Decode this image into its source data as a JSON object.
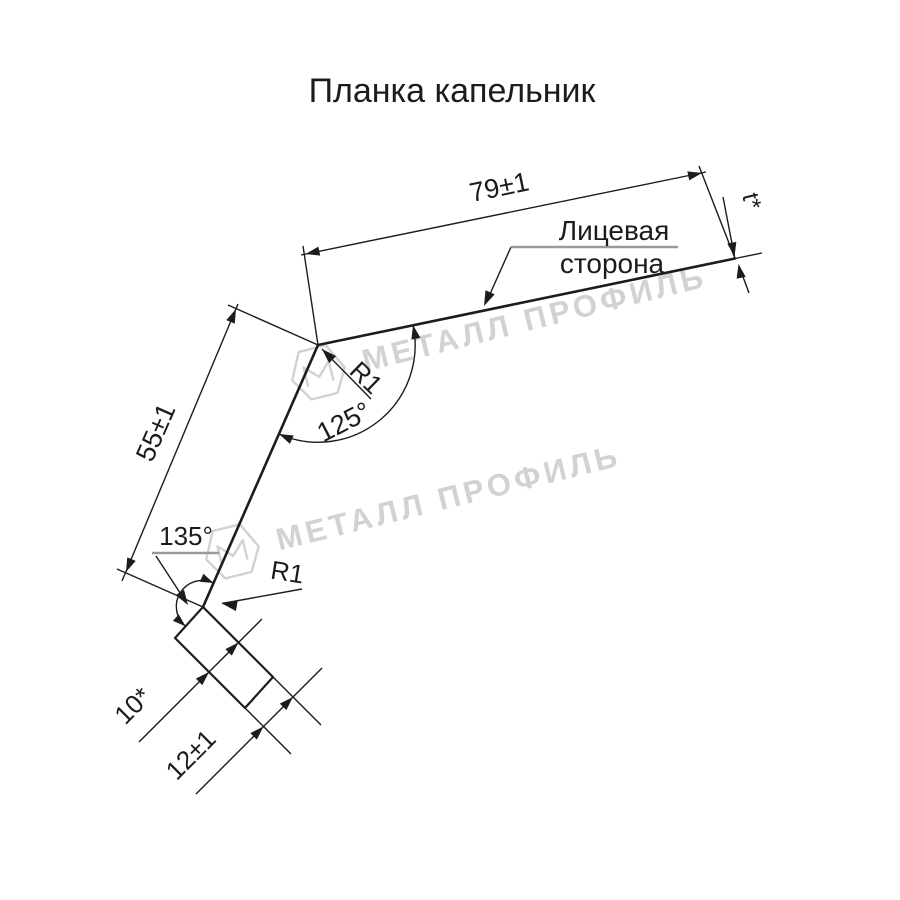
{
  "title": "Планка капельник",
  "drawing": {
    "dims": {
      "top_length": "79±1",
      "thickness": "t*",
      "web_length": "55±1",
      "angle_top": "125°",
      "angle_bottom": "135°",
      "radius_top": "R1",
      "radius_bottom": "R1",
      "hem_width": "10*",
      "hem_length": "12±1"
    },
    "labels": {
      "face_side_line1": "Лицевая",
      "face_side_line2": "сторона"
    },
    "watermark": {
      "text": "МЕТАЛЛ ПРОФИЛЬ"
    },
    "colors": {
      "line": "#1c1c1c",
      "underline": "#9a9a9a",
      "watermark": "#d2d2d2",
      "background": "#ffffff"
    }
  }
}
